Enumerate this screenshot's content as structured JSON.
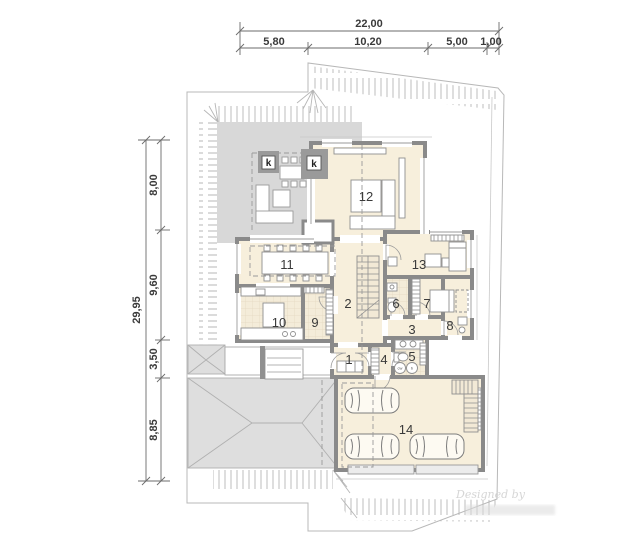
{
  "dimensions": {
    "top": {
      "total": "22,00",
      "seg1": "5,80",
      "seg2": "10,20",
      "seg3": "5,00",
      "seg4": "1,00"
    },
    "left": {
      "total": "29,95",
      "seg1": "8,00",
      "seg2": "9,60",
      "seg3": "3,50",
      "seg4": "8,85"
    }
  },
  "rooms": {
    "r1": "1",
    "r2": "2",
    "r3": "3",
    "r4": "4",
    "r5": "5",
    "r6": "6",
    "r7": "7",
    "r8": "8",
    "r9": "9",
    "r10": "10",
    "r11": "11",
    "r12": "12",
    "r13": "13",
    "r14": "14"
  },
  "fireplaces": {
    "k1": "k",
    "k2": "k"
  },
  "appliances": {
    "washer": "cw",
    "boiler": "b"
  },
  "watermark": {
    "line1": "Designed by"
  },
  "colors": {
    "wall": "#8a8a8a",
    "room_fill": "#f7efdc",
    "terrace": "#d8d8d8",
    "driveway": "#dedede",
    "dim_text": "#3a3a3a",
    "hatch": "#adadad"
  }
}
